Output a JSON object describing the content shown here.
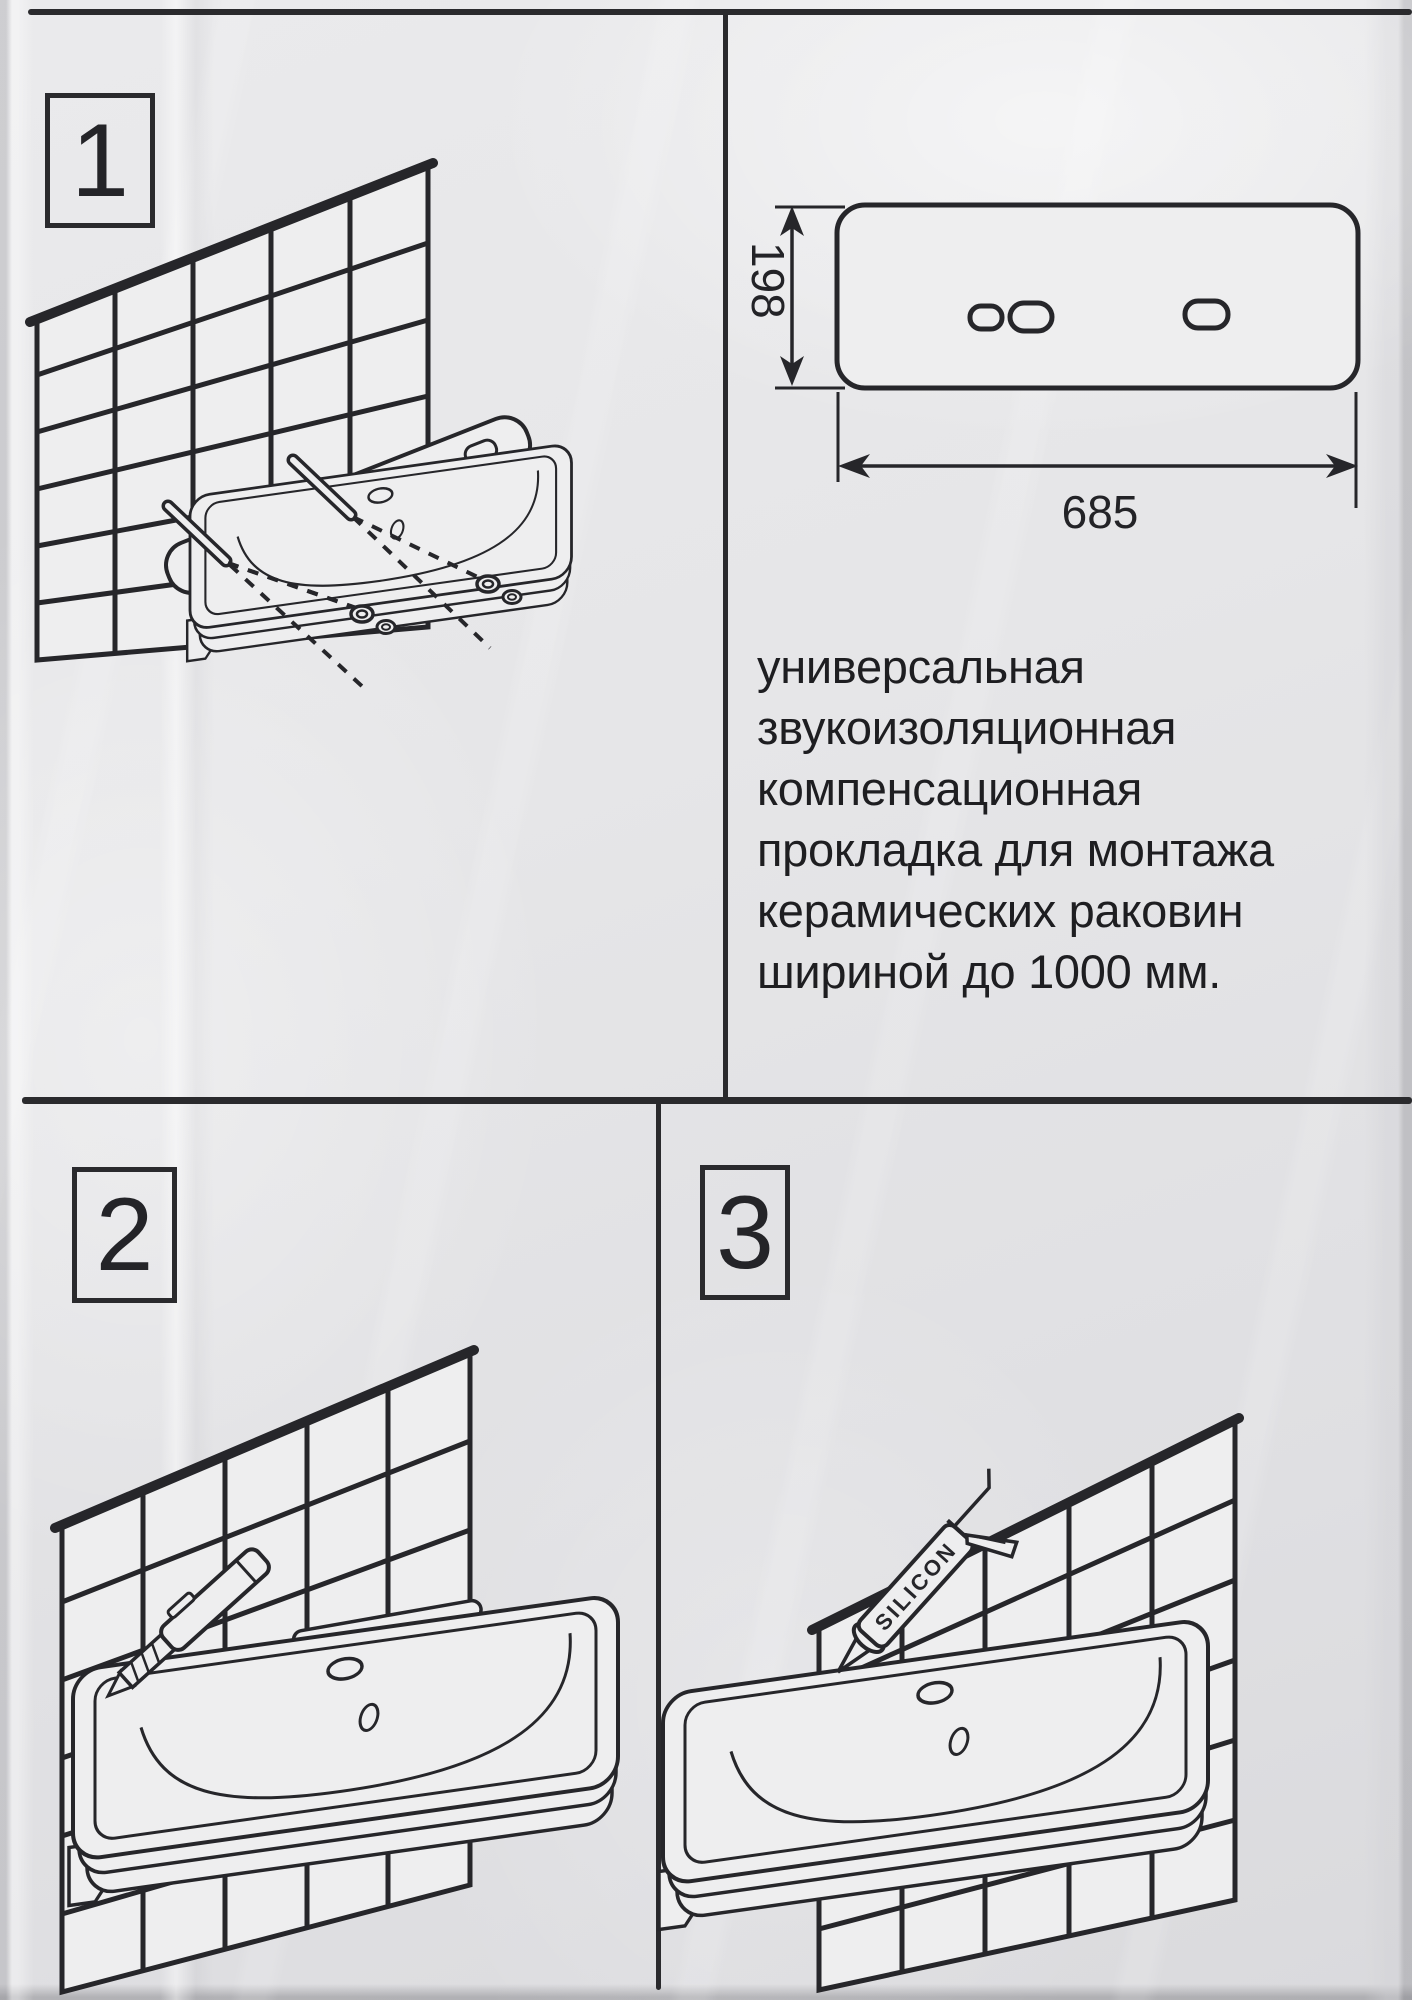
{
  "sheet": {
    "steps": [
      {
        "number": "1",
        "illustration": "sink-above-tiled-wall-with-mounting-pins-and-gasket"
      },
      {
        "number": "2",
        "illustration": "trimming-gasket-with-utility-knife"
      },
      {
        "number": "3",
        "illustration": "sealing-sink-joint-with-silicone-gun",
        "tool_label": "SILICON"
      }
    ],
    "dimension_drawing": {
      "height_label": "198",
      "width_label": "685",
      "shape": "gasket-outline-with-three-slots"
    },
    "description_lines": [
      "универсальная",
      "звукоизоляционная",
      "компенсационная",
      "прокладка для монтажа",
      "керамических раковин",
      "шириной до 1000 мм."
    ],
    "colors": {
      "ink": "#26262a",
      "paper": "#eeeeef",
      "background": "#e6e6e8"
    }
  }
}
